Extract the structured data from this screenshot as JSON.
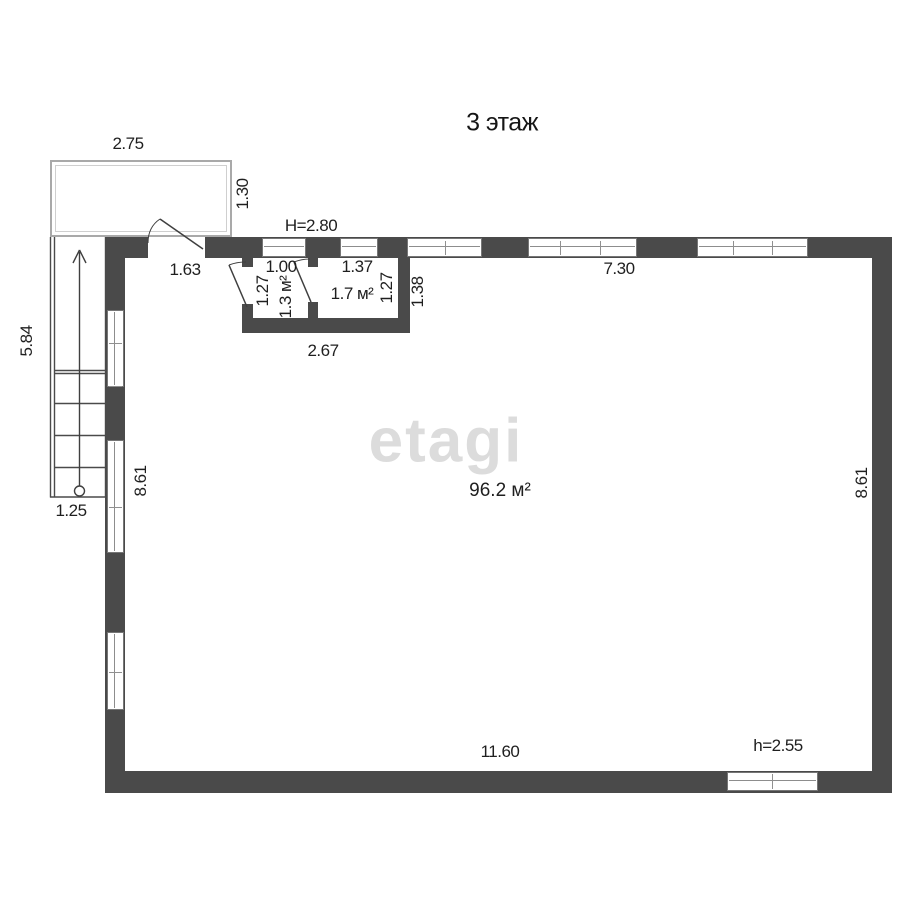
{
  "title": "3 этаж",
  "watermark": "etagi",
  "colors": {
    "wall": "#4a4a4a",
    "text": "#1f1f1f",
    "watermark": "#dcdcdc"
  },
  "dimensions": {
    "balcony_width": "2.75",
    "balcony_depth": "1.30",
    "stair_run": "5.84",
    "stair_width": "1.25",
    "ceiling_height": "H=2.80",
    "balcony_door_offset": "1.63",
    "room1_width": "1.00",
    "room1_depth": "1.27",
    "room1_area": "1.3 м²",
    "room2_width": "1.37",
    "room2_depth": "1.27",
    "room2_area": "1.7 м²",
    "rooms_width": "2.67",
    "rooms_depth_outer": "1.38",
    "top_window_run": "7.30",
    "left_inner_depth": "8.61",
    "right_inner_depth": "8.61",
    "bottom_inner_width": "11.60",
    "bottom_window_height": "h=2.55",
    "main_room_area": "96.2 м²"
  }
}
